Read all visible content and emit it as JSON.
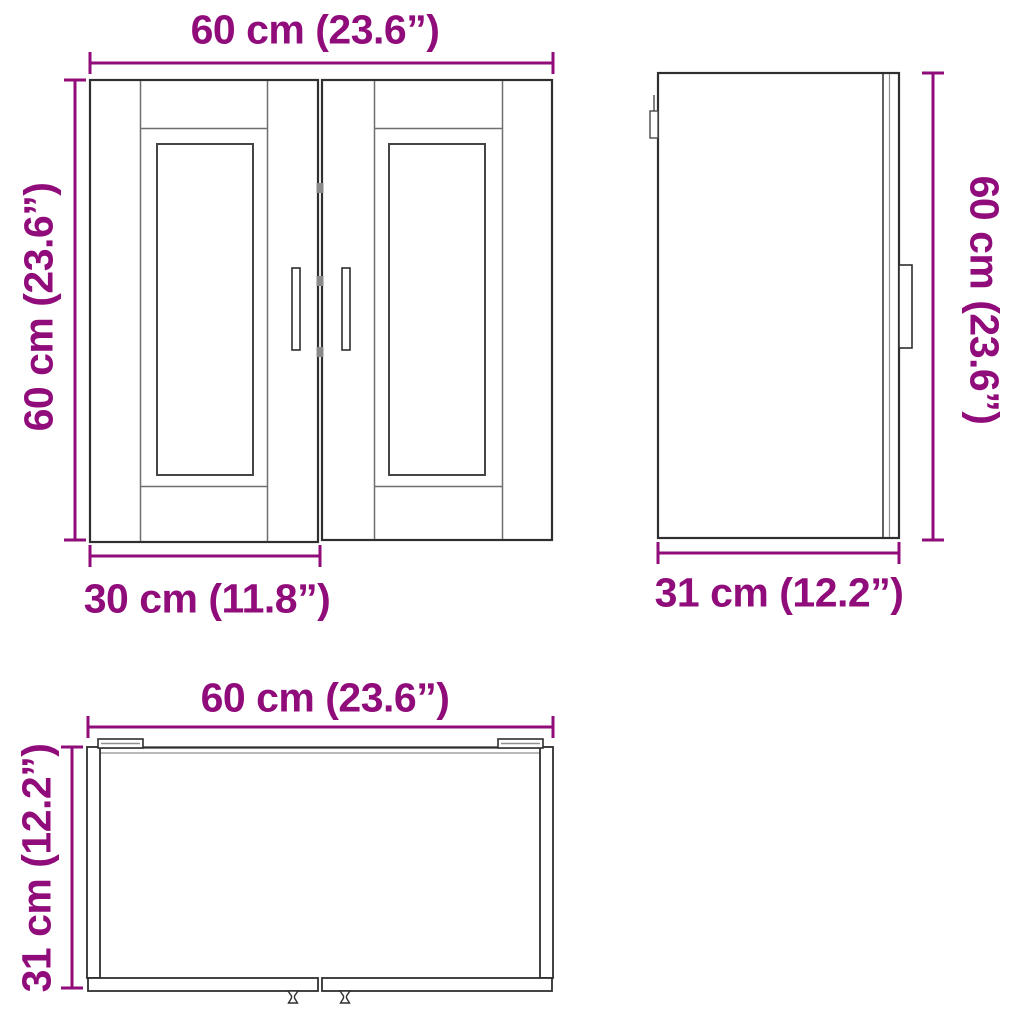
{
  "diagram": {
    "type": "furniture-dimension-diagram",
    "subject": "kitchen wall cabinet with two framed doors",
    "colors": {
      "dimension_text": "#910c7b",
      "dimension_line": "#910c7b",
      "outline_dark": "#2f2f2f",
      "outline_soft": "#8f8f8f",
      "background": "#ffffff"
    },
    "front_view": {
      "width_label": "60 cm (23.6”)",
      "height_label": "60 cm (23.6”)",
      "door_width_label": "30 cm (11.8”)"
    },
    "side_view": {
      "height_label": "60 cm (23.6”)",
      "depth_label": "31 cm (12.2”)"
    },
    "top_view": {
      "width_label": "60 cm (23.6”)",
      "depth_label": "31 cm (12.2”)"
    }
  }
}
